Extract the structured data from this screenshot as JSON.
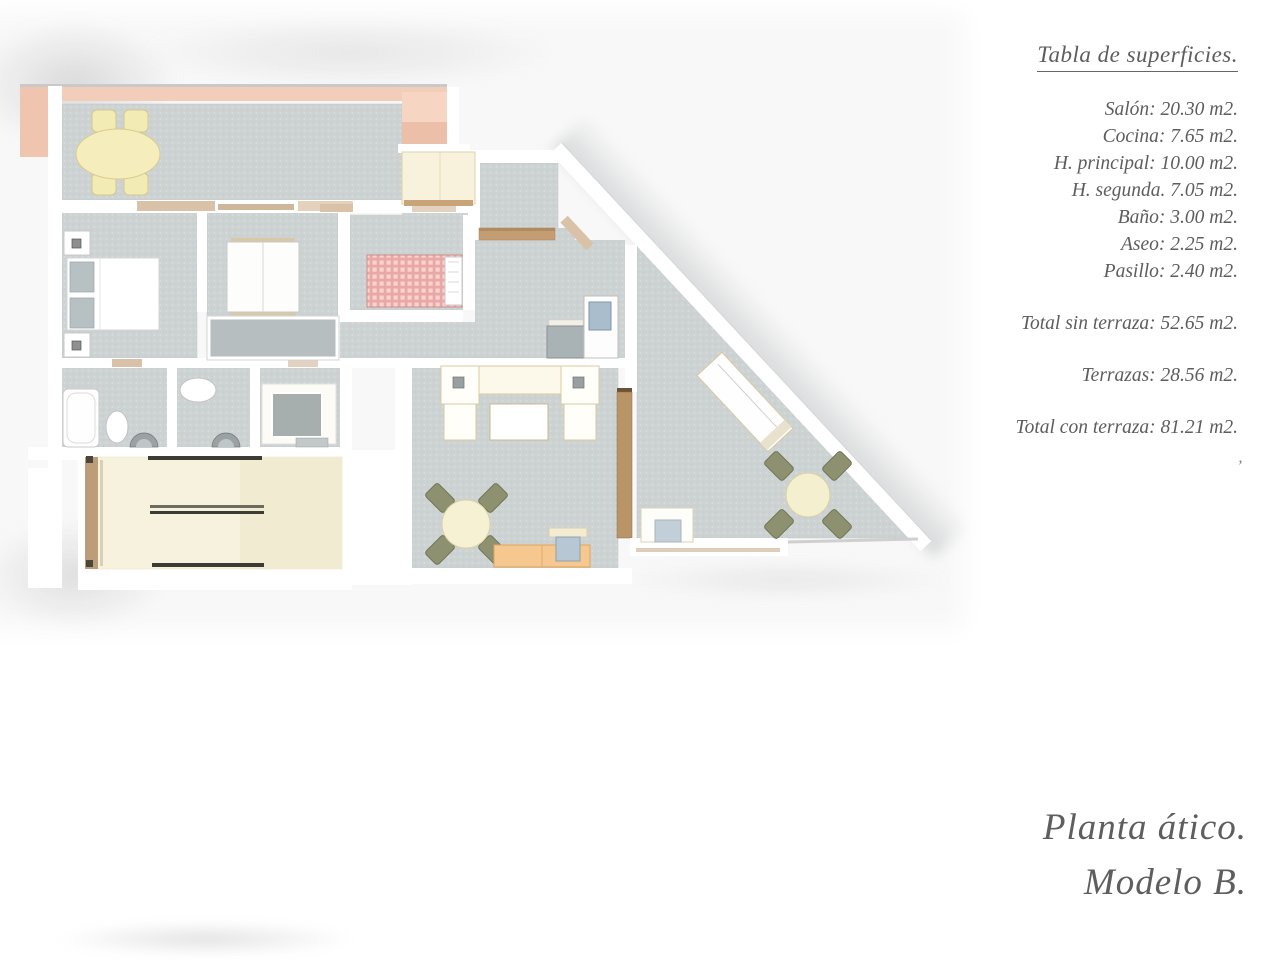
{
  "surfaces": {
    "title": "Tabla de superficies.",
    "rooms": [
      "Salón: 20.30 m2.",
      "Cocina: 7.65 m2.",
      "H. principal: 10.00 m2.",
      "H. segunda. 7.05 m2.",
      "Baño: 3.00 m2.",
      "Aseo: 2.25 m2.",
      "Pasillo: 2.40 m2."
    ],
    "total_without_terrace": "Total sin terraza: 52.65 m2.",
    "terraces": "Terrazas: 28.56 m2.",
    "total_with_terrace": "Total con terraza: 81.21 m2.",
    "stray_mark": "’"
  },
  "plan_title": {
    "line1": "Planta ático.",
    "line2": "Modelo B."
  },
  "colors": {
    "text_gray": "#5d5d5d",
    "wall_white": "#ffffff",
    "terrace_band_pink": "#f2cdb9",
    "floor_gray": "#cdd3d3",
    "furniture_cream": "#f5eebc",
    "stairs_cream": "#f7f2dd",
    "wood_brown": "#bb9d79",
    "plaid_red": "#eeb3b0",
    "sideboard_orange": "#f6c78e",
    "chair_olive": "#8d9170",
    "fixture_gray": "#9aa2a4",
    "appliance_blue": "#a9bdcd"
  }
}
